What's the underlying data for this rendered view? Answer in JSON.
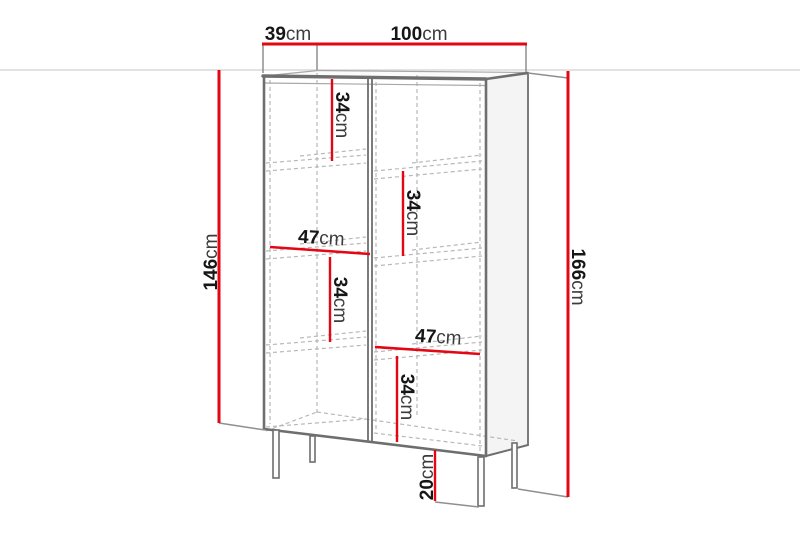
{
  "diagram": {
    "kind": "furniture-dimension-drawing",
    "dimensions": {
      "depth": {
        "value": "39",
        "unit": "cm"
      },
      "width": {
        "value": "100",
        "unit": "cm"
      },
      "body_height": {
        "value": "146",
        "unit": "cm"
      },
      "total_height": {
        "value": "166",
        "unit": "cm"
      },
      "cell_top_left": {
        "value": "34",
        "unit": "cm"
      },
      "cell_upper_right": {
        "value": "34",
        "unit": "cm"
      },
      "cell_middle_left": {
        "value": "34",
        "unit": "cm"
      },
      "cell_lower_right": {
        "value": "34",
        "unit": "cm"
      },
      "inner_width_left": {
        "value": "47",
        "unit": "cm"
      },
      "inner_width_right": {
        "value": "47",
        "unit": "cm"
      },
      "leg_height": {
        "value": "20",
        "unit": "cm"
      }
    },
    "colors": {
      "dimension_red": "#e30613",
      "cabinet_gray": "#6e6e6e",
      "hidden_gray": "#b8b8b8",
      "backedge_gray": "#a8a8a8",
      "wall_gray": "#d8d8d8",
      "witness_gray": "#8f8f8f",
      "text_black": "#161616",
      "unit_gray": "#3c3c3c",
      "side_panel_fill": "#f4f4f4",
      "top_panel_fill": "#fbfbfb",
      "front_fill": "#ffffff"
    }
  }
}
